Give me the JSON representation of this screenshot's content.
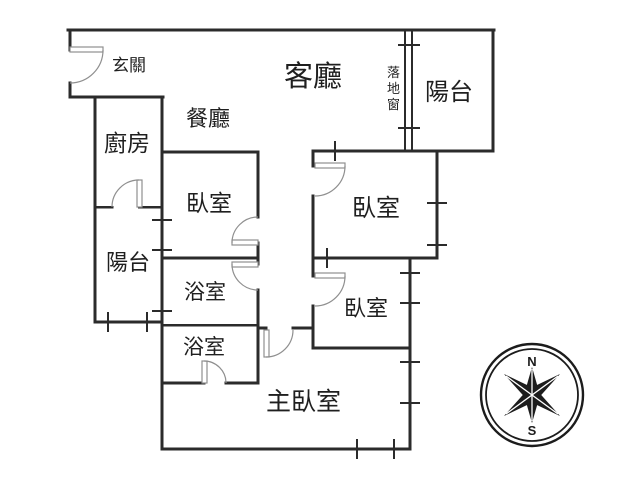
{
  "page": {
    "width": 640,
    "height": 480,
    "background": "#ffffff",
    "wall_color": "#2b2b2b",
    "door_color": "#8f8f8f",
    "text_color": "#1f1f1f",
    "compass_color": "#1c1c1c"
  },
  "floorplan": {
    "walls": [
      [
        68,
        30,
        494,
        30,
        3
      ],
      [
        70,
        97,
        163,
        97,
        3
      ],
      [
        162,
        152,
        258,
        152,
        3
      ],
      [
        313,
        151,
        493,
        151,
        3
      ],
      [
        95,
        207,
        112,
        207,
        2.5
      ],
      [
        139,
        207,
        162,
        207,
        2.5
      ],
      [
        162,
        258,
        258,
        258,
        3
      ],
      [
        313,
        258,
        437,
        258,
        3
      ],
      [
        162,
        325,
        258,
        325,
        2.5
      ],
      [
        258,
        328,
        266,
        328,
        3
      ],
      [
        293,
        328,
        313,
        328,
        3
      ],
      [
        95,
        322,
        162,
        322,
        3
      ],
      [
        313,
        348,
        410,
        348,
        3
      ],
      [
        162,
        383,
        204,
        383,
        3
      ],
      [
        226,
        383,
        258,
        383,
        3
      ],
      [
        162,
        449,
        410,
        449,
        3
      ],
      [
        70,
        30,
        70,
        50,
        3
      ],
      [
        70,
        83,
        70,
        97,
        3
      ],
      [
        95,
        97,
        95,
        322,
        3
      ],
      [
        162,
        97,
        162,
        449,
        3
      ],
      [
        258,
        152,
        258,
        217,
        3
      ],
      [
        258,
        243,
        258,
        264,
        3
      ],
      [
        258,
        290,
        258,
        383,
        3
      ],
      [
        313,
        151,
        313,
        166,
        3
      ],
      [
        313,
        196,
        313,
        276,
        3
      ],
      [
        313,
        306,
        313,
        348,
        3
      ],
      [
        405,
        30,
        405,
        151,
        2
      ],
      [
        412,
        30,
        412,
        151,
        2
      ],
      [
        437,
        151,
        437,
        258,
        3
      ],
      [
        410,
        258,
        410,
        449,
        3
      ],
      [
        493,
        30,
        493,
        151,
        3
      ]
    ],
    "window_ticks": [
      [
        398,
        45,
        420,
        45
      ],
      [
        398,
        128,
        420,
        128
      ],
      [
        427,
        203,
        447,
        203
      ],
      [
        427,
        245,
        447,
        245
      ],
      [
        400,
        273,
        420,
        273
      ],
      [
        400,
        303,
        420,
        303
      ],
      [
        400,
        362,
        420,
        362
      ],
      [
        400,
        403,
        420,
        403
      ],
      [
        335,
        141,
        335,
        161
      ],
      [
        327,
        248,
        327,
        268
      ],
      [
        108,
        312,
        108,
        332
      ],
      [
        147,
        312,
        147,
        332
      ],
      [
        152,
        220,
        172,
        220
      ],
      [
        152,
        250,
        172,
        250
      ],
      [
        152,
        311,
        172,
        311
      ],
      [
        357,
        439,
        357,
        459
      ],
      [
        394,
        439,
        394,
        459
      ]
    ],
    "doors": [
      {
        "name": "entry-door",
        "leaf": [
          70,
          47,
          33,
          5
        ],
        "arc": [
          103,
          50,
          33,
          1,
          70,
          83
        ]
      },
      {
        "name": "kitchen-door",
        "leaf": [
          137,
          180,
          5,
          27
        ],
        "arc": [
          139,
          180,
          27,
          0,
          112,
          207
        ]
      },
      {
        "name": "bedroom-left-door",
        "leaf": [
          232,
          240,
          26,
          5
        ],
        "arc": [
          232,
          243,
          26,
          1,
          258,
          217
        ]
      },
      {
        "name": "bathroom-upper-door",
        "leaf": [
          232,
          262,
          26,
          5
        ],
        "arc": [
          232,
          264,
          26,
          0,
          258,
          290
        ]
      },
      {
        "name": "bedroom-upper-right-door",
        "leaf": [
          315,
          163,
          30,
          5
        ],
        "arc": [
          345,
          166,
          30,
          1,
          315,
          196
        ]
      },
      {
        "name": "bedroom-lower-right-door",
        "leaf": [
          315,
          273,
          30,
          5
        ],
        "arc": [
          345,
          276,
          30,
          1,
          315,
          306
        ]
      },
      {
        "name": "bathroom-lower-door",
        "leaf": [
          202,
          361,
          5,
          22
        ],
        "arc": [
          204,
          361,
          22,
          1,
          226,
          383
        ]
      },
      {
        "name": "master-bedroom-door",
        "leaf": [
          264,
          330,
          5,
          27
        ],
        "arc": [
          266,
          357,
          27,
          0,
          293,
          330
        ]
      }
    ],
    "labels": [
      {
        "name": "entry",
        "text": "玄關",
        "x": 112,
        "y": 71,
        "size": 17
      },
      {
        "name": "living-room",
        "text": "客廳",
        "x": 284,
        "y": 86,
        "size": 29
      },
      {
        "name": "sliding-glass-door",
        "text": "落地窗",
        "x": 387,
        "y": 77,
        "size": 13,
        "vertical": true,
        "line_step": 16
      },
      {
        "name": "balcony-top-right",
        "text": "陽台",
        "x": 425,
        "y": 100,
        "size": 24
      },
      {
        "name": "dining-room",
        "text": "餐廳",
        "x": 186,
        "y": 126,
        "size": 22
      },
      {
        "name": "kitchen",
        "text": "廚房",
        "x": 104,
        "y": 151,
        "size": 23
      },
      {
        "name": "bedroom-left",
        "text": "臥室",
        "x": 186,
        "y": 211,
        "size": 23
      },
      {
        "name": "bedroom-upper-right",
        "text": "臥室",
        "x": 352,
        "y": 216,
        "size": 24
      },
      {
        "name": "balcony-left",
        "text": "陽台",
        "x": 106,
        "y": 270,
        "size": 22
      },
      {
        "name": "bathroom-upper",
        "text": "浴室",
        "x": 184,
        "y": 299,
        "size": 21
      },
      {
        "name": "bedroom-lower-right",
        "text": "臥室",
        "x": 344,
        "y": 316,
        "size": 22
      },
      {
        "name": "bathroom-lower",
        "text": "浴室",
        "x": 183,
        "y": 354,
        "size": 21
      },
      {
        "name": "master-bedroom",
        "text": "主臥室",
        "x": 266,
        "y": 410,
        "size": 25
      }
    ]
  },
  "compass": {
    "cx": 532,
    "cy": 395,
    "outer_r": 51,
    "inner_r": 46,
    "ring_width_outer": 2.4,
    "ring_width_inner": 1.8,
    "north_label": "N",
    "south_label": "S",
    "north_xy": [
      532,
      366
    ],
    "south_xy": [
      532,
      435
    ],
    "star_polygons": [
      "504,374 527.8,400.6 560,416 536.2,389.4",
      "560,374 527.8,389.4 504,416 536.2,400.6",
      "532,367 540,395 532,423 524,395"
    ],
    "seam_lines": [
      [
        532,
        369,
        532,
        421
      ],
      [
        506,
        376,
        558,
        414
      ],
      [
        558,
        376,
        506,
        414
      ]
    ]
  }
}
